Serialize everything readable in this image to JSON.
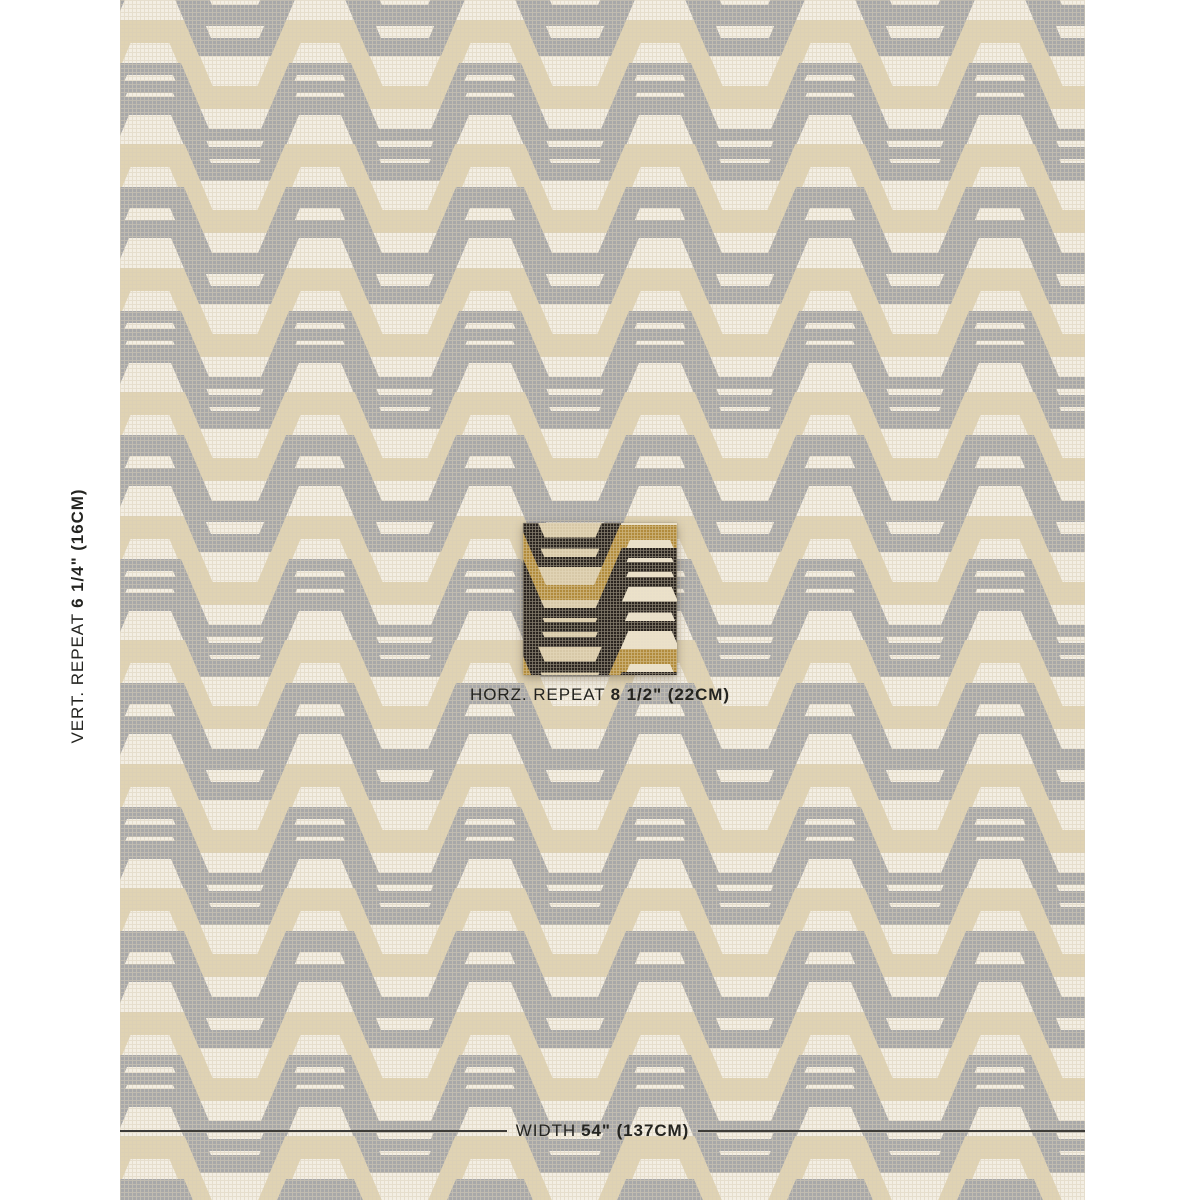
{
  "spec": {
    "vert_repeat_label": "VERT. REPEAT",
    "vert_repeat_value": "6 1/4\" (16CM)",
    "horz_repeat_label": "HORZ. REPEAT",
    "horz_repeat_value": "8 1/2\" (22CM)",
    "width_label": "WIDTH",
    "width_value": "54\" (137CM)"
  },
  "colors": {
    "page_background": "#ffffff",
    "text": "#242420",
    "rule_line": "#3e3c38",
    "faded_pattern": {
      "cream_ground": "#f3eee3",
      "tan_band": "#e0d3b3",
      "gray_stripe": "#a8a8a9",
      "texture_line": "#d8cdb6"
    },
    "swatch": {
      "oatmeal_ground": "#d7c8a7",
      "cream_peak": "#ece3cf",
      "gold_band": "#b18b3c",
      "black_stripe": "#2a241f",
      "texture_line": "#efe5ca"
    }
  }
}
